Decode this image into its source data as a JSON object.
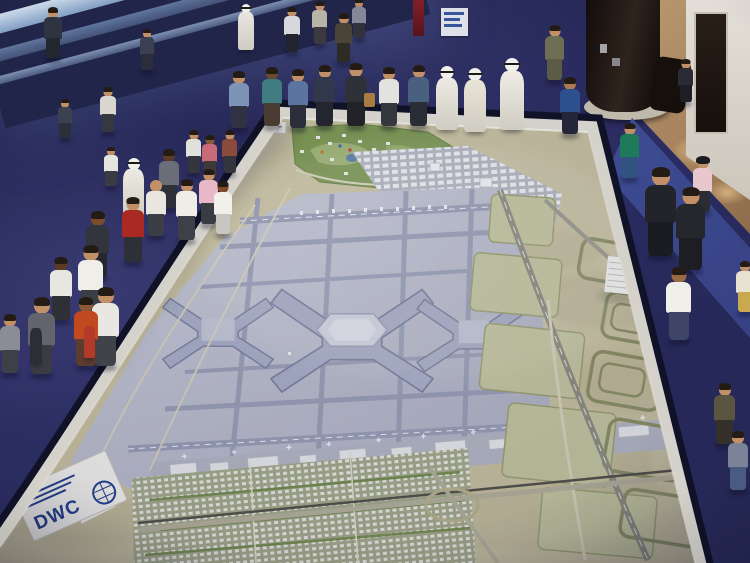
{
  "photo": {
    "subject": "Visitors viewing a giant airport master-plan scale model at an exhibition"
  },
  "plaque": {
    "logo": "DWC"
  },
  "colors": {
    "carpet": "#2c2e5e",
    "carpet_light": "#3a3d77",
    "runner": "#46549f",
    "sand": "#c9c3a2",
    "apron": "#bfc2cf",
    "runway": "#9aa0b6",
    "terminal": "#a9afc6",
    "golf_green": "#7f9a55",
    "table_edge": "#dfddd2",
    "table_rim": "#101226",
    "plaque_blue": "#24418c"
  },
  "figures": [
    {
      "x": 44,
      "y": 8,
      "h": 52,
      "s": "#2e3440",
      "p": "#232830"
    },
    {
      "x": 58,
      "y": 100,
      "h": 40,
      "s": "#3a4150",
      "p": "#2a2f3a"
    },
    {
      "x": 100,
      "y": 88,
      "h": 46,
      "s": "#d8d6ce",
      "p": "#35383f"
    },
    {
      "x": 140,
      "y": 30,
      "h": 42,
      "s": "#3a3f52",
      "p": "#2a2d3a"
    },
    {
      "x": 238,
      "y": 4,
      "h": 46,
      "s": "#e8e6e0",
      "robe": true
    },
    {
      "x": 284,
      "y": 8,
      "h": 46,
      "s": "#d8d8dc",
      "p": "#23252e"
    },
    {
      "x": 312,
      "y": 2,
      "h": 44,
      "s": "#b9b4a8",
      "p": "#3a3a40"
    },
    {
      "x": 335,
      "y": 14,
      "h": 50,
      "s": "#4a4438",
      "p": "#2e2a24"
    },
    {
      "x": 352,
      "y": 0,
      "h": 40,
      "s": "#8b8f9e",
      "p": "#33343c"
    },
    {
      "x": 545,
      "y": 26,
      "h": 56,
      "s": "#6e6e54",
      "p": "#5c5c46"
    },
    {
      "x": 678,
      "y": 60,
      "h": 44,
      "s": "#2b2b33",
      "p": "#1e1e24"
    },
    {
      "x": 229,
      "y": 72,
      "h": 58,
      "s": "#7d93b8",
      "p": "#2f3240"
    },
    {
      "x": 262,
      "y": 68,
      "h": 60,
      "s": "#3f7d80",
      "p": "#4a3b33",
      "skin": "#6b4a2f"
    },
    {
      "x": 288,
      "y": 70,
      "h": 60,
      "s": "#5b74a0",
      "p": "#2c2f3a"
    },
    {
      "x": 314,
      "y": 66,
      "h": 62,
      "s": "#31384c",
      "p": "#23262f"
    },
    {
      "x": 345,
      "y": 64,
      "h": 64,
      "s": "#2e3138",
      "p": "#222329",
      "bag": "#a87c42"
    },
    {
      "x": 379,
      "y": 68,
      "h": 60,
      "s": "#e3e2de",
      "p": "#35373f"
    },
    {
      "x": 408,
      "y": 66,
      "h": 62,
      "s": "#49607e",
      "p": "#2b2d36"
    },
    {
      "x": 436,
      "y": 66,
      "h": 64,
      "s": "#ece9e2",
      "robe": true
    },
    {
      "x": 464,
      "y": 68,
      "h": 64,
      "s": "#e9e4d8",
      "robe": true
    },
    {
      "x": 500,
      "y": 58,
      "h": 72,
      "s": "#efece4",
      "robe": true
    },
    {
      "x": 560,
      "y": 78,
      "h": 58,
      "s": "#2e4f8e",
      "p": "#23263a",
      "skin": "#b07a52"
    },
    {
      "x": 104,
      "y": 148,
      "h": 40,
      "s": "#e6e4de",
      "p": "#3a3c44"
    },
    {
      "x": 123,
      "y": 158,
      "h": 62,
      "s": "#eceae2",
      "robe": true
    },
    {
      "x": 146,
      "y": 180,
      "h": 58,
      "s": "#e8e6df",
      "p": "#3c3e46",
      "skin": "#c4906a",
      "bald": true
    },
    {
      "x": 186,
      "y": 131,
      "h": 44,
      "s": "#e2e0da",
      "p": "#34363e"
    },
    {
      "x": 202,
      "y": 136,
      "h": 44,
      "s": "#c86a78",
      "p": "#403a36",
      "skin": "#8a5a34"
    },
    {
      "x": 222,
      "y": 131,
      "h": 44,
      "s": "#8a4a3c",
      "p": "#33343c"
    },
    {
      "x": 159,
      "y": 150,
      "h": 60,
      "s": "#6a6e78",
      "p": "#2e3038",
      "skin": "#5d3c26"
    },
    {
      "x": 176,
      "y": 180,
      "h": 62,
      "s": "#efede6",
      "p": "#3e4048"
    },
    {
      "x": 199,
      "y": 170,
      "h": 56,
      "s": "#e8b8c8",
      "p": "#3a3c44"
    },
    {
      "x": 214,
      "y": 182,
      "h": 54,
      "s": "#f2f0ea",
      "p": "#c8c6c0",
      "skin": "#7a4c2c"
    },
    {
      "x": 122,
      "y": 198,
      "h": 66,
      "s": "#a82a22",
      "p": "#2e3038"
    },
    {
      "x": 86,
      "y": 212,
      "h": 68,
      "s": "#33353c",
      "p": "#26282e",
      "skin": "#7a4c2c"
    },
    {
      "x": 78,
      "y": 246,
      "h": 74,
      "s": "#f0eee8",
      "p": "#3c3e46"
    },
    {
      "x": 50,
      "y": 258,
      "h": 64,
      "s": "#e8e6e0",
      "p": "#2e3036",
      "skin": "#5d3c26"
    },
    {
      "x": 92,
      "y": 288,
      "h": 80,
      "s": "#e9e7e1",
      "p": "#41434b"
    },
    {
      "x": 74,
      "y": 298,
      "h": 70,
      "s": "#c2491f",
      "p": "#5a3c30",
      "skin": "#8a5a34"
    },
    {
      "x": 28,
      "y": 298,
      "h": 78,
      "s": "#63646e",
      "p": "#3a3b43"
    },
    {
      "x": 0,
      "y": 315,
      "h": 60,
      "s": "#8a8c96",
      "p": "#3e4048"
    },
    {
      "x": 30,
      "y": 328,
      "h": 36,
      "s": "#2c2e36",
      "partial": true
    },
    {
      "x": 84,
      "y": 326,
      "h": 32,
      "s": "#b23a28",
      "partial": true
    },
    {
      "x": 620,
      "y": 124,
      "h": 56,
      "s": "#1e7a58",
      "p": "#31547e"
    },
    {
      "x": 645,
      "y": 168,
      "h": 90,
      "s": "#23242a",
      "p": "#1b1c21"
    },
    {
      "x": 676,
      "y": 188,
      "h": 84,
      "s": "#26272d",
      "p": "#1d1e23"
    },
    {
      "x": 693,
      "y": 158,
      "h": 56,
      "s": "#e8c8cc",
      "p": "#2c2d33",
      "hat": "#1c1c20"
    },
    {
      "x": 666,
      "y": 268,
      "h": 74,
      "s": "#f0efe9",
      "p": "#3f4566",
      "skin": "#9a6a42"
    },
    {
      "x": 736,
      "y": 262,
      "h": 52,
      "s": "#e6e2d2",
      "p": "#caa94e"
    },
    {
      "x": 714,
      "y": 384,
      "h": 62,
      "s": "#5a5540",
      "p": "#35312a"
    },
    {
      "x": 728,
      "y": 432,
      "h": 60,
      "s": "#7a8398",
      "p": "#4a5b82"
    }
  ]
}
